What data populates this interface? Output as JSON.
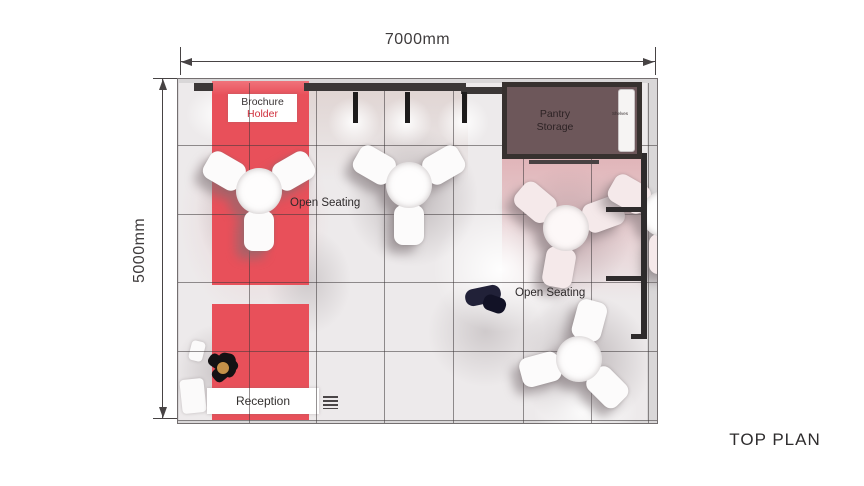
{
  "title": "TOP PLAN",
  "dimensions": {
    "width": "7000mm",
    "height": "5000mm"
  },
  "areas": {
    "brochure": {
      "line1": "Brochure",
      "line2": "Holder"
    },
    "pantry": {
      "line1": "Pantry",
      "line2": "Storage",
      "shelves": "Shelves"
    },
    "open_seating_left": "Open Seating",
    "open_seating_right": "Open Seating",
    "reception": "Reception"
  },
  "colors": {
    "carpet_red": "#e8505a",
    "accent_red_text": "#cf2f3c",
    "pantry_fill": "#6d575a",
    "wall_dark": "#3b3737",
    "floor_gray": "#edeaeb",
    "pink_tint": "#d99399",
    "person_navy": "#212138",
    "head_tan": "#c59149",
    "text_dark": "#343031"
  }
}
